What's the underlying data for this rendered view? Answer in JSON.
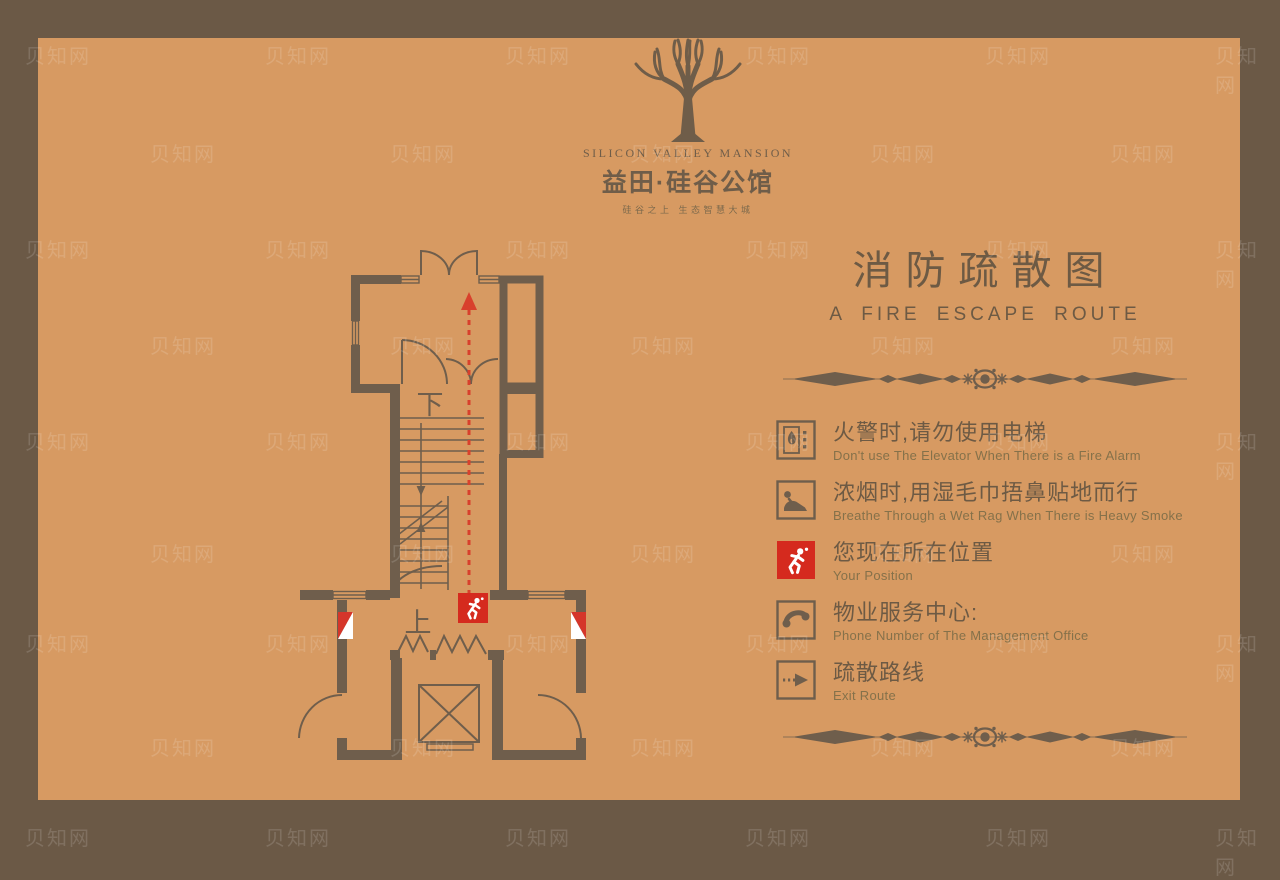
{
  "brand": {
    "name_en": "SILICON VALLEY MANSION",
    "name_cn": "益田·硅谷公馆",
    "tagline": "硅谷之上  生态智慧大城"
  },
  "title": {
    "cn": "消防疏散图",
    "en": "A  FIRE  ESCAPE  ROUTE"
  },
  "plan": {
    "stair_down_label": "下",
    "stair_up_label": "上"
  },
  "legend": {
    "items": [
      {
        "icon": "no-elevator-on-fire-icon",
        "cn": "火警时,请勿使用电梯",
        "en": "Don't use The Elevator When There is a Fire Alarm"
      },
      {
        "icon": "crawl-under-smoke-icon",
        "cn": "浓烟时,用湿毛巾捂鼻贴地而行",
        "en": "Breathe Through a Wet Rag When There is Heavy Smoke"
      },
      {
        "icon": "your-position-icon",
        "cn": "您现在所在位置",
        "en": "Your Position"
      },
      {
        "icon": "phone-icon",
        "cn": "物业服务中心:",
        "en": "Phone Number of The Management Office"
      },
      {
        "icon": "exit-route-icon",
        "cn": "疏散路线",
        "en": "Exit  Route"
      }
    ]
  },
  "watermark": {
    "text": "贝知网"
  },
  "colors": {
    "frame": "#6b5946",
    "background": "#d79a62",
    "line": "#6f5e4c",
    "text": "#6d5a44",
    "subtext": "#85714a",
    "red": "#d52a1e"
  }
}
